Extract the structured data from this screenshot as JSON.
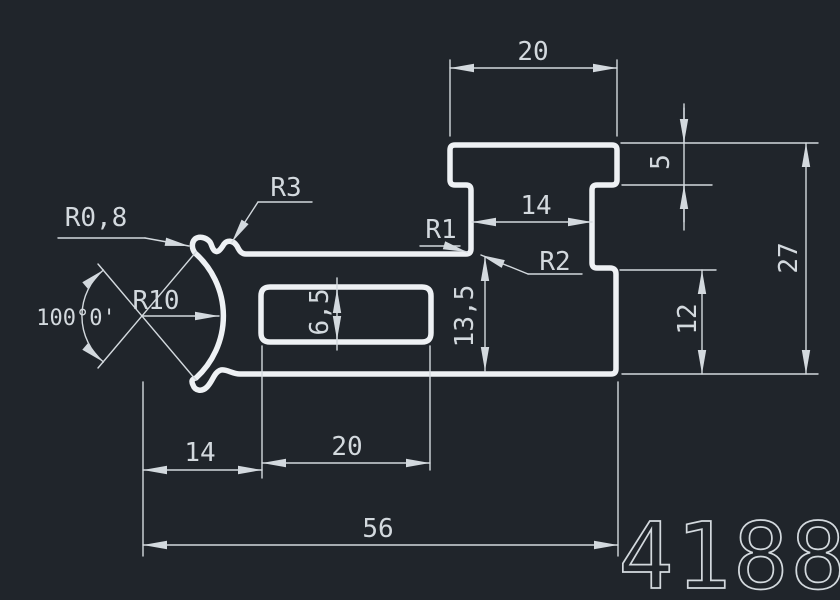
{
  "drawing": {
    "part_number": "4188",
    "colors": {
      "background": "#20252b",
      "profile": "#eef1f4",
      "dimension": "#d3d9de"
    },
    "labels": {
      "cap_width": "20",
      "cap_height": "5",
      "neck_width": "14",
      "total_height": "27",
      "step_height": "12",
      "arm_height": "13,5",
      "slot_height": "6,5",
      "crescent_offset": "14",
      "slot_width": "20",
      "total_width": "56",
      "radius_tip": "R0,8",
      "radius_hook": "R3",
      "radius_groove": "R10",
      "radius_corner_1": "R1",
      "radius_corner_2": "R2",
      "groove_angle": "100°0'"
    }
  }
}
